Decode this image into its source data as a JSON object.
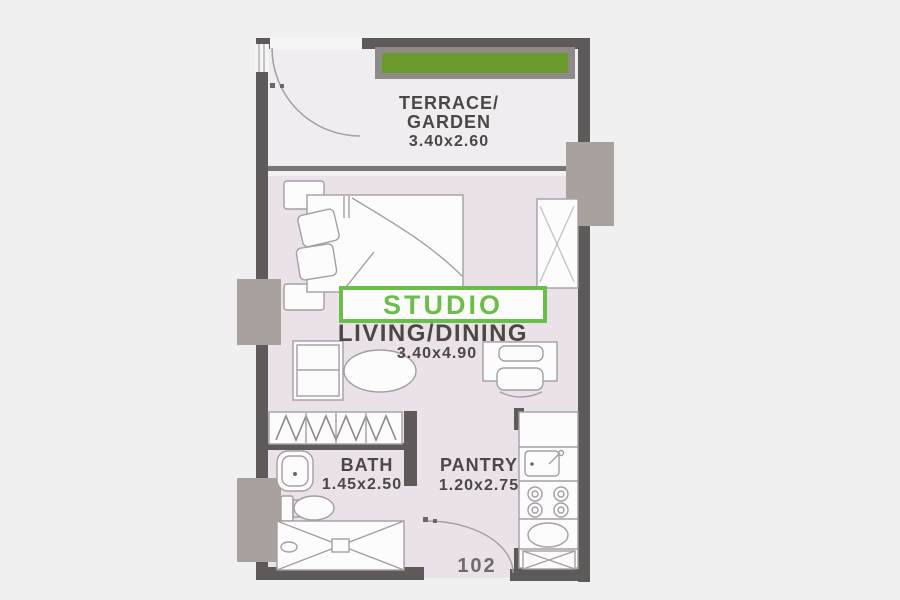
{
  "unit": {
    "number": "102"
  },
  "rooms": {
    "terrace": {
      "label_line1": "TERRACE/",
      "label_line2": "GARDEN",
      "dimensions": "3.40x2.60"
    },
    "studio": {
      "tag": "STUDIO",
      "label": "LIVING/DINING",
      "dimensions": "3.40x4.90"
    },
    "bath": {
      "label": "BATH",
      "dimensions": "1.45x2.50"
    },
    "pantry": {
      "label": "PANTRY",
      "dimensions": "1.20x2.75"
    }
  },
  "colors": {
    "background": "#f1f0f0",
    "wall": "#5e5a5a",
    "column": "#a9a19d",
    "floor": "#eae2e8",
    "terrace_floor": "#f0edf0",
    "opening_white": "#f6f5f5",
    "planter_green": "#6a9b2c",
    "planter_frame": "#8d8a88",
    "accent_green": "#6abf4a",
    "text": "#4b4747",
    "unit_text": "#6f6b6b",
    "furniture_stroke": "#a49ea4"
  }
}
